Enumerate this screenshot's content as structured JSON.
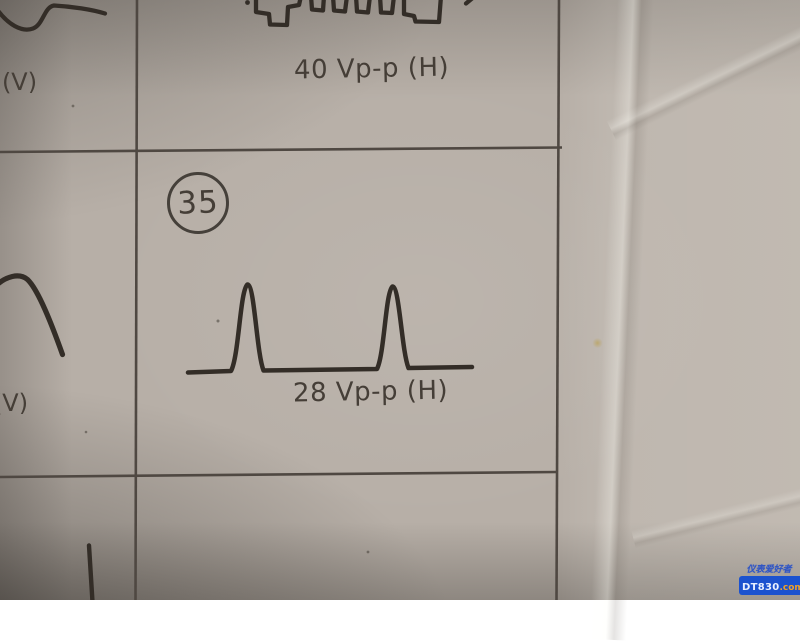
{
  "document": {
    "kind": "service-manual waveform chart (photographed paper page)",
    "cells": {
      "top_waveform": {
        "label": "40 Vp-p (H)",
        "waveform": "pulse-train-waveform"
      },
      "middle_waveform": {
        "step_number": "35",
        "label": "28 Vp-p (H)",
        "waveform": "two-pulse-waveform"
      },
      "left_top": {
        "label": "(V)",
        "waveform": "dip-curve-waveform"
      },
      "left_middle": {
        "label": "(V)",
        "waveform": "falling-arc-waveform"
      },
      "left_bottom": {
        "waveform": "vertical-stroke-waveform"
      }
    }
  },
  "watermark": {
    "line1": "仪表爱好者",
    "brand": "DT830",
    "suffix": ".com"
  },
  "colors": {
    "paper": "#b7afa7",
    "ink": "#332d27",
    "grid_line": "#4f4842",
    "text": "#453e37",
    "watermark_blue": "#2f55c5",
    "watermark_pill_bg": "#1b52cf",
    "watermark_brand_text": "#e7efff",
    "watermark_suffix_orange": "#f0a028"
  }
}
